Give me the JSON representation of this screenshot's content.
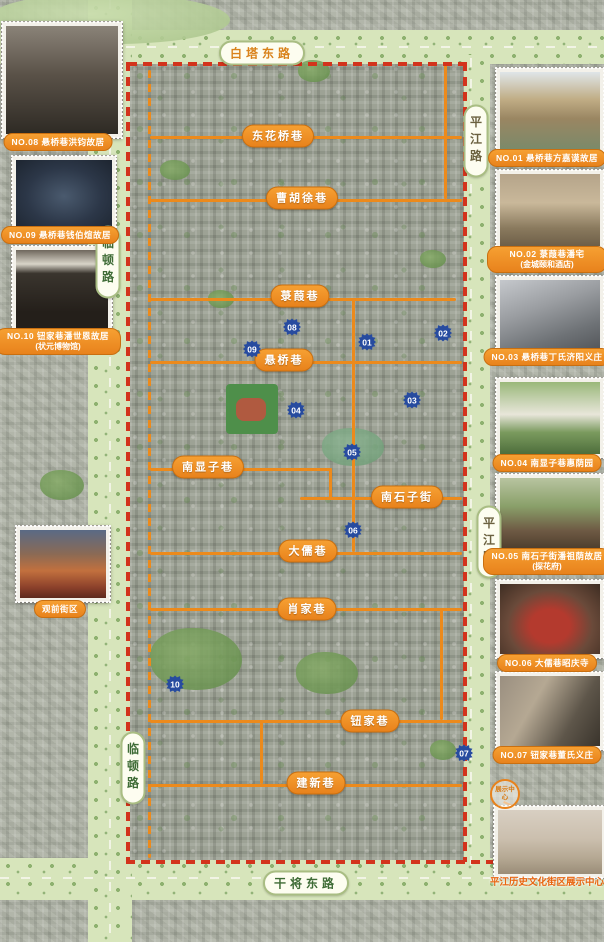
{
  "roads": {
    "top": "白塔东路",
    "bottom": "干将东路",
    "right_upper": "平江路",
    "right_lower": "平江路",
    "left_upper": "临顿路",
    "left_lower": "临顿路"
  },
  "lanes": [
    "东花桥巷",
    "曹胡徐巷",
    "菉葭巷",
    "悬桥巷",
    "南显子巷",
    "南石子街",
    "大儒巷",
    "肖家巷",
    "钮家巷",
    "建新巷"
  ],
  "markers": [
    "01",
    "02",
    "03",
    "04",
    "05",
    "06",
    "07",
    "08",
    "09",
    "10"
  ],
  "left_photos": [
    {
      "caption": "NO.08  悬桥巷洪钧故居"
    },
    {
      "caption": "NO.09  悬桥巷钱伯煊故居"
    },
    {
      "caption": "NO.10  钮家巷潘世恩故居",
      "caption2": "(状元博物馆)"
    },
    {
      "caption": "观前街区"
    }
  ],
  "right_photos": [
    {
      "caption": "NO.01  悬桥巷方嘉谟故居"
    },
    {
      "caption": "NO.02  菉葭巷潘宅",
      "caption2": "(金城颐和酒店)"
    },
    {
      "caption": "NO.03  悬桥巷丁氏济阳义庄"
    },
    {
      "caption": "NO.04  南显子巷惠荫园"
    },
    {
      "caption": "NO.05  南石子街潘祖荫故居",
      "caption2": "(探花府)"
    },
    {
      "caption": "NO.06  大儒巷昭庆寺"
    },
    {
      "caption": "NO.07  钮家巷董氏义庄"
    }
  ],
  "exhibition_center": {
    "caption": "平江历史文化街区展示中心",
    "circle_label": "展示中心"
  },
  "colors": {
    "badge_orange": "#ee8a1c",
    "boundary_red": "#d3331c",
    "marker_blue": "#274b9f",
    "road_green": "#d7e5bb"
  }
}
